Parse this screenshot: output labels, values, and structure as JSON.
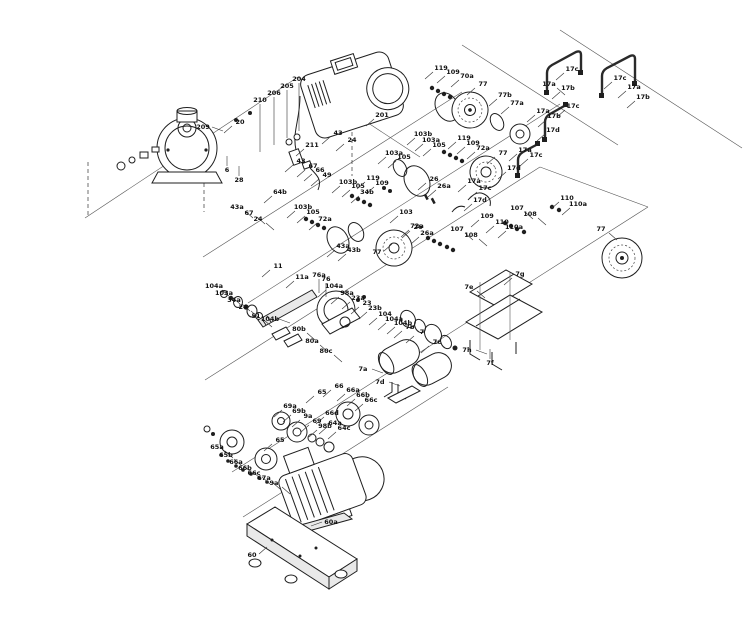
{
  "figure": {
    "type": "exploded-parts-diagram",
    "subject": "Pump assembly exploded view with numbered part callouts",
    "ink_color": "#1f1f1f",
    "label_color": "#111111",
    "background": "#ffffff"
  },
  "callouts": [
    {
      "t": "209",
      "x": 203,
      "y": 129,
      "d": "r"
    },
    {
      "t": "20",
      "x": 240,
      "y": 124,
      "d": "dl"
    },
    {
      "t": "210",
      "x": 260,
      "y": 102,
      "d": "dv"
    },
    {
      "t": "206",
      "x": 274,
      "y": 95,
      "d": "dv"
    },
    {
      "t": "205",
      "x": 287,
      "y": 88,
      "d": "dv"
    },
    {
      "t": "204",
      "x": 299,
      "y": 81,
      "d": "dv"
    },
    {
      "t": "201",
      "x": 382,
      "y": 117,
      "d": "dl"
    },
    {
      "t": "211",
      "x": 312,
      "y": 147,
      "d": "dl"
    },
    {
      "t": "6",
      "x": 227,
      "y": 172,
      "d": "u"
    },
    {
      "t": "28",
      "x": 239,
      "y": 182,
      "d": "u"
    },
    {
      "t": "43",
      "x": 301,
      "y": 163,
      "d": "dl"
    },
    {
      "t": "67",
      "x": 313,
      "y": 168,
      "d": "dl"
    },
    {
      "t": "66",
      "x": 320,
      "y": 172,
      "d": "dl"
    },
    {
      "t": "49",
      "x": 327,
      "y": 177,
      "d": "dl"
    },
    {
      "t": "64b",
      "x": 280,
      "y": 194,
      "d": "dl"
    },
    {
      "t": "43a",
      "x": 237,
      "y": 209,
      "d": "dr"
    },
    {
      "t": "67",
      "x": 249,
      "y": 215,
      "d": "dr"
    },
    {
      "t": "24",
      "x": 258,
      "y": 221,
      "d": "dr"
    },
    {
      "t": "43",
      "x": 338,
      "y": 135,
      "d": "dl"
    },
    {
      "t": "24",
      "x": 352,
      "y": 142,
      "d": "dl"
    },
    {
      "t": "103",
      "x": 406,
      "y": 214,
      "d": "dl"
    },
    {
      "t": "72a",
      "x": 417,
      "y": 228,
      "d": "dl"
    },
    {
      "t": "119",
      "x": 441,
      "y": 70,
      "d": "dl"
    },
    {
      "t": "109",
      "x": 453,
      "y": 74,
      "d": "dl"
    },
    {
      "t": "70a",
      "x": 467,
      "y": 78,
      "d": "dl"
    },
    {
      "t": "77",
      "x": 483,
      "y": 86,
      "d": "dl"
    },
    {
      "t": "77b",
      "x": 505,
      "y": 97,
      "d": "dl"
    },
    {
      "t": "77a",
      "x": 517,
      "y": 105,
      "d": "dl"
    },
    {
      "t": "17c",
      "x": 572,
      "y": 71,
      "d": "dl"
    },
    {
      "t": "17a",
      "x": 549,
      "y": 86,
      "d": "dr"
    },
    {
      "t": "17b",
      "x": 568,
      "y": 90,
      "d": "dl"
    },
    {
      "t": "17c",
      "x": 620,
      "y": 80,
      "d": "dl"
    },
    {
      "t": "17a",
      "x": 634,
      "y": 89,
      "d": "dl"
    },
    {
      "t": "17b",
      "x": 643,
      "y": 99,
      "d": "dl"
    },
    {
      "t": "17a",
      "x": 543,
      "y": 113,
      "d": "dl"
    },
    {
      "t": "17c",
      "x": 573,
      "y": 108,
      "d": "dl"
    },
    {
      "t": "17b",
      "x": 554,
      "y": 118,
      "d": "dl"
    },
    {
      "t": "17d",
      "x": 553,
      "y": 132,
      "d": "dl"
    },
    {
      "t": "17a",
      "x": 525,
      "y": 152,
      "d": "dl"
    },
    {
      "t": "17c",
      "x": 536,
      "y": 157,
      "d": "dl"
    },
    {
      "t": "17d",
      "x": 514,
      "y": 170,
      "d": "dl"
    },
    {
      "t": "103b",
      "x": 423,
      "y": 136,
      "d": "dl"
    },
    {
      "t": "103a",
      "x": 431,
      "y": 142,
      "d": "dl"
    },
    {
      "t": "105",
      "x": 439,
      "y": 147,
      "d": "dl"
    },
    {
      "t": "119",
      "x": 464,
      "y": 140,
      "d": "dl"
    },
    {
      "t": "109",
      "x": 473,
      "y": 145,
      "d": "dl"
    },
    {
      "t": "72a",
      "x": 483,
      "y": 150,
      "d": "dl"
    },
    {
      "t": "77",
      "x": 503,
      "y": 155,
      "d": "dl"
    },
    {
      "t": "103a",
      "x": 394,
      "y": 155,
      "d": "dl"
    },
    {
      "t": "105",
      "x": 404,
      "y": 159,
      "d": "dl"
    },
    {
      "t": "103b",
      "x": 348,
      "y": 184,
      "d": "dl"
    },
    {
      "t": "105",
      "x": 358,
      "y": 188,
      "d": "dl"
    },
    {
      "t": "34b",
      "x": 367,
      "y": 194,
      "d": "dl"
    },
    {
      "t": "119",
      "x": 373,
      "y": 180,
      "d": "dl"
    },
    {
      "t": "109",
      "x": 382,
      "y": 185,
      "d": "dl"
    },
    {
      "t": "26",
      "x": 434,
      "y": 181,
      "d": "dl"
    },
    {
      "t": "26a",
      "x": 444,
      "y": 188,
      "d": "dl"
    },
    {
      "t": "17a",
      "x": 474,
      "y": 183,
      "d": "dl"
    },
    {
      "t": "17c",
      "x": 485,
      "y": 190,
      "d": "dl"
    },
    {
      "t": "17d",
      "x": 480,
      "y": 202,
      "d": "dl"
    },
    {
      "t": "77",
      "x": 601,
      "y": 231,
      "d": "dr"
    },
    {
      "t": "103b",
      "x": 303,
      "y": 209,
      "d": "dl"
    },
    {
      "t": "105",
      "x": 313,
      "y": 214,
      "d": "dl"
    },
    {
      "t": "72a",
      "x": 325,
      "y": 221,
      "d": "dl"
    },
    {
      "t": "43a",
      "x": 343,
      "y": 248,
      "d": "dl"
    },
    {
      "t": "43b",
      "x": 354,
      "y": 252,
      "d": "dl"
    },
    {
      "t": "77",
      "x": 377,
      "y": 254,
      "d": "ur"
    },
    {
      "t": "26",
      "x": 418,
      "y": 229,
      "d": "dl"
    },
    {
      "t": "26a",
      "x": 427,
      "y": 235,
      "d": "dl"
    },
    {
      "t": "109",
      "x": 487,
      "y": 218,
      "d": "dl"
    },
    {
      "t": "110",
      "x": 502,
      "y": 224,
      "d": "dl"
    },
    {
      "t": "110a",
      "x": 514,
      "y": 229,
      "d": "dl"
    },
    {
      "t": "107",
      "x": 457,
      "y": 231,
      "d": "dr"
    },
    {
      "t": "108",
      "x": 471,
      "y": 237,
      "d": "dr"
    },
    {
      "t": "107",
      "x": 517,
      "y": 210,
      "d": "dr"
    },
    {
      "t": "108",
      "x": 530,
      "y": 216,
      "d": "dr"
    },
    {
      "t": "110",
      "x": 567,
      "y": 200,
      "d": "dl"
    },
    {
      "t": "110a",
      "x": 578,
      "y": 206,
      "d": "dl"
    },
    {
      "t": "104a",
      "x": 214,
      "y": 288,
      "d": "dr"
    },
    {
      "t": "103a",
      "x": 224,
      "y": 295,
      "d": "dr"
    },
    {
      "t": "34a",
      "x": 234,
      "y": 302,
      "d": "dr"
    },
    {
      "t": "24",
      "x": 243,
      "y": 309,
      "d": "dr"
    },
    {
      "t": "51",
      "x": 256,
      "y": 318,
      "d": "dr"
    },
    {
      "t": "11",
      "x": 278,
      "y": 268,
      "d": "dl"
    },
    {
      "t": "11a",
      "x": 302,
      "y": 279,
      "d": "dl"
    },
    {
      "t": "76a",
      "x": 319,
      "y": 277,
      "d": "d"
    },
    {
      "t": "76",
      "x": 326,
      "y": 281,
      "d": "d"
    },
    {
      "t": "104a",
      "x": 334,
      "y": 288,
      "d": "dl"
    },
    {
      "t": "104b",
      "x": 270,
      "y": 321,
      "d": "r"
    },
    {
      "t": "80b",
      "x": 299,
      "y": 331,
      "d": "dr"
    },
    {
      "t": "80a",
      "x": 312,
      "y": 343,
      "d": "dr"
    },
    {
      "t": "80c",
      "x": 326,
      "y": 353,
      "d": "dr"
    },
    {
      "t": "98a",
      "x": 347,
      "y": 295,
      "d": "dl"
    },
    {
      "t": "23a",
      "x": 358,
      "y": 300,
      "d": "dl"
    },
    {
      "t": "23",
      "x": 367,
      "y": 305,
      "d": "dl"
    },
    {
      "t": "23b",
      "x": 375,
      "y": 310,
      "d": "dl"
    },
    {
      "t": "104",
      "x": 385,
      "y": 316,
      "d": "dl"
    },
    {
      "t": "104a",
      "x": 394,
      "y": 321,
      "d": "dl"
    },
    {
      "t": "104b",
      "x": 403,
      "y": 325,
      "d": "dl"
    },
    {
      "t": "7b",
      "x": 410,
      "y": 329,
      "d": "dl"
    },
    {
      "t": "7",
      "x": 422,
      "y": 334,
      "d": "dl"
    },
    {
      "t": "7c",
      "x": 437,
      "y": 344,
      "d": "dl"
    },
    {
      "t": "7a",
      "x": 363,
      "y": 371,
      "d": "r"
    },
    {
      "t": "7d",
      "x": 380,
      "y": 384,
      "d": "r"
    },
    {
      "t": "7e",
      "x": 469,
      "y": 289,
      "d": "dr"
    },
    {
      "t": "7g",
      "x": 520,
      "y": 276,
      "d": "dl"
    },
    {
      "t": "7h",
      "x": 467,
      "y": 352,
      "d": "r"
    },
    {
      "t": "7f",
      "x": 490,
      "y": 365,
      "d": "u"
    },
    {
      "t": "65",
      "x": 322,
      "y": 394,
      "d": "dl"
    },
    {
      "t": "66",
      "x": 339,
      "y": 388,
      "d": "dl"
    },
    {
      "t": "66a",
      "x": 353,
      "y": 392,
      "d": "dl"
    },
    {
      "t": "66b",
      "x": 363,
      "y": 397,
      "d": "dl"
    },
    {
      "t": "66c",
      "x": 371,
      "y": 402,
      "d": "dl"
    },
    {
      "t": "66d",
      "x": 332,
      "y": 415,
      "d": "dl"
    },
    {
      "t": "69a",
      "x": 290,
      "y": 408,
      "d": "dl"
    },
    {
      "t": "69b",
      "x": 299,
      "y": 413,
      "d": "dl"
    },
    {
      "t": "9a",
      "x": 308,
      "y": 418,
      "d": "dl"
    },
    {
      "t": "69",
      "x": 317,
      "y": 423,
      "d": "dl"
    },
    {
      "t": "98b",
      "x": 325,
      "y": 428,
      "d": "dl"
    },
    {
      "t": "64a",
      "x": 335,
      "y": 425,
      "d": "dl"
    },
    {
      "t": "64c",
      "x": 344,
      "y": 430,
      "d": "dl"
    },
    {
      "t": "65a",
      "x": 217,
      "y": 449,
      "d": "dr"
    },
    {
      "t": "65b",
      "x": 226,
      "y": 457,
      "d": "dr"
    },
    {
      "t": "66a",
      "x": 236,
      "y": 464,
      "d": "dr"
    },
    {
      "t": "66b",
      "x": 245,
      "y": 470,
      "d": "dr"
    },
    {
      "t": "66c",
      "x": 254,
      "y": 475,
      "d": "dr"
    },
    {
      "t": "67a",
      "x": 264,
      "y": 480,
      "d": "dr"
    },
    {
      "t": "9a",
      "x": 274,
      "y": 485,
      "d": "dr"
    },
    {
      "t": "65",
      "x": 280,
      "y": 442,
      "d": "dl"
    },
    {
      "t": "60",
      "x": 252,
      "y": 557,
      "d": "ur"
    },
    {
      "t": "60a",
      "x": 331,
      "y": 524,
      "d": "l"
    }
  ]
}
